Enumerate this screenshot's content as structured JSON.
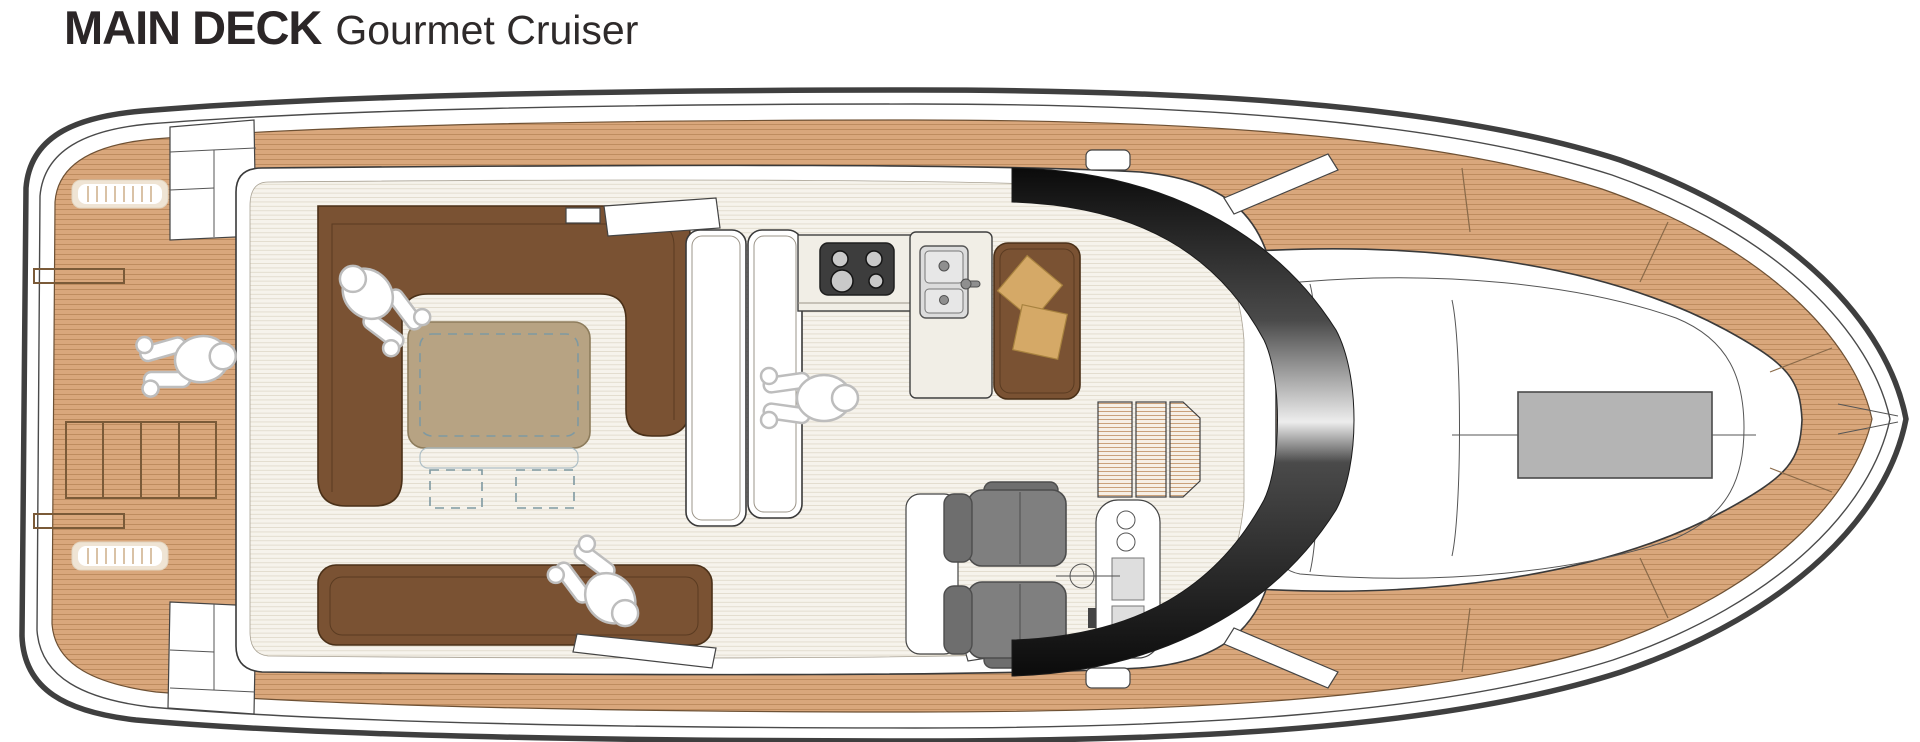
{
  "header": {
    "title": "MAIN DECK",
    "subtitle": "Gourmet Cruiser"
  },
  "diagram": {
    "label": "yacht-main-deck-floor-plan",
    "vessel_orientation": "bow-right",
    "figure_count": 4,
    "features": [
      "aft-teak-deck",
      "deck-grate-hatches",
      "storage-locker-grid",
      "boarding-steps",
      "cockpit-u-sofa",
      "cockpit-table-with-folding-leaves",
      "aft-bench-sofa",
      "sliding-door-leaves",
      "galley-island",
      "four-burner-stove",
      "double-sink-with-faucet",
      "settee-with-pillows",
      "twin-helm-seats",
      "helm-console-with-gauges",
      "steering-wheel",
      "companionway-stairs",
      "curved-windshield",
      "foredeck-lounge",
      "foredeck-hatch",
      "bow-teak-walkaround",
      "crew-figures"
    ]
  },
  "colors": {
    "teak": "#d9a77c",
    "teak_line": "#be8c5f",
    "hull_outline": "#3f3f3f",
    "sofa_brown": "#7a5233",
    "table_tan": "#b7a383",
    "pillow_tan": "#d5a967",
    "floor_cream": "#f6f3ec",
    "floor_line": "#e1dbcc",
    "seat_gray": "#7f7f7f",
    "stove_dark": "#3d3d3d",
    "hatch_gray": "#b4b4b4",
    "figure_outline": "#bdbdbd",
    "title_color": "#2b2627",
    "windshield_dark": "#0b0b0b",
    "windshield_highlight": "#ededed"
  }
}
